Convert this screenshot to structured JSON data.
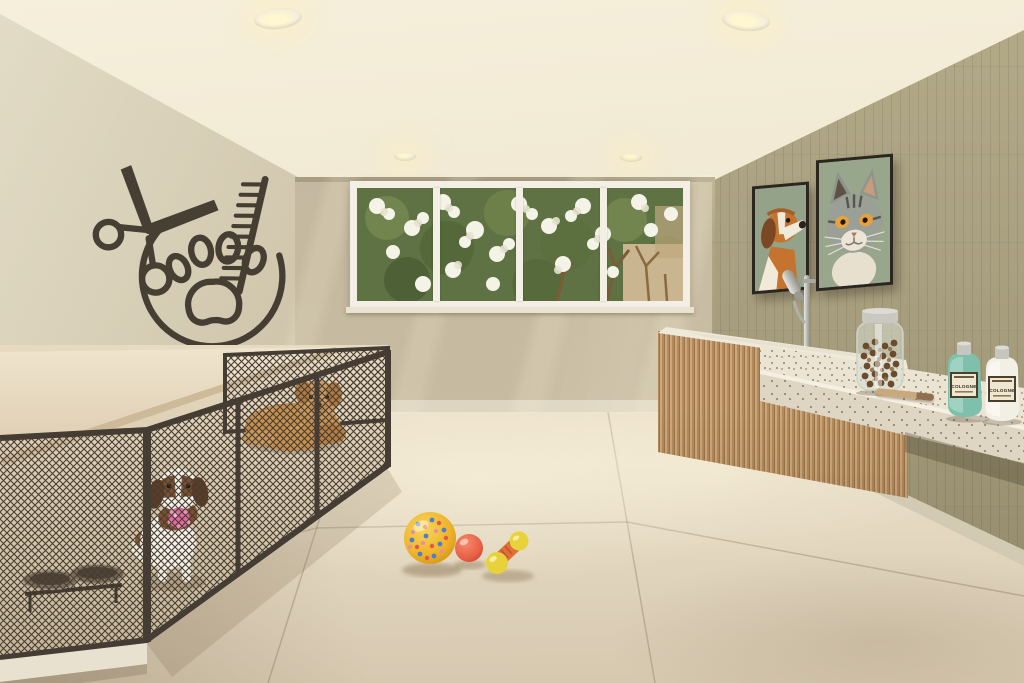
{
  "scene": {
    "type": "interior-rendering",
    "room": "pet grooming room",
    "palette": {
      "ceiling": "#f0e8d2",
      "left_wall": "#c6bca2",
      "back_wall": "#c3b79e",
      "right_wall": "#a69d7d",
      "floor": "#e9dfcb",
      "wood_cabinet": "#b8905f",
      "terrazzo_counter": "#ece4d2",
      "mesh_frame": "#463d33",
      "accent_teal": "#7fc0ad",
      "logo_ink": "#3b3329"
    },
    "signage": {
      "wall_logo": {
        "description": "grooming logo wall decal",
        "icons": [
          "scissors-icon",
          "paw-print-icon",
          "comb-icon",
          "circle-arc"
        ]
      }
    },
    "window": {
      "pane_count": 4,
      "view": "tree with white blossoms"
    },
    "artwork": [
      {
        "subject": "beagle dog portrait"
      },
      {
        "subject": "tabby cat portrait"
      }
    ],
    "kennel": {
      "pets": [
        {
          "name": "beagle puppy",
          "toy": "pink ball"
        },
        {
          "name": "apricot fluffy dog"
        }
      ],
      "bowl_count": 2
    },
    "wash_station": {
      "items": [
        "shower-handle",
        "treat-jar",
        "grooming-brush"
      ]
    },
    "counter": {
      "bottles": [
        {
          "label": "COLOGNE",
          "body_color": "#7fc0ad"
        },
        {
          "label": "COLOGNE",
          "body_color": "#f2efe5"
        }
      ]
    },
    "floor_toys": [
      {
        "name": "spotted ball"
      },
      {
        "name": "red ball"
      },
      {
        "name": "dumbbell chew toy"
      }
    ],
    "lighting": {
      "downlights": 4
    }
  }
}
